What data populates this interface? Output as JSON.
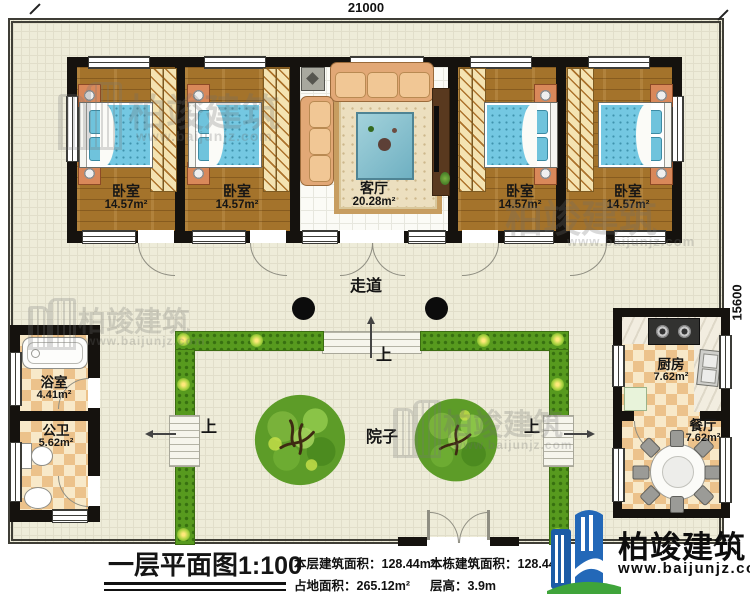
{
  "dims": {
    "top": "21000",
    "right": "15600"
  },
  "rooms": {
    "bedroom1": {
      "name": "卧室",
      "area": "14.57m²"
    },
    "bedroom2": {
      "name": "卧室",
      "area": "14.57m²"
    },
    "living": {
      "name": "客厅",
      "area": "20.28m²"
    },
    "bedroom3": {
      "name": "卧室",
      "area": "14.57m²"
    },
    "bedroom4": {
      "name": "卧室",
      "area": "14.57m²"
    },
    "bath": {
      "name": "浴室",
      "area": "4.41m²"
    },
    "wc": {
      "name": "公卫",
      "area": "5.62m²"
    },
    "kitchen": {
      "name": "厨房",
      "area": "7.62m²"
    },
    "dining": {
      "name": "餐厅",
      "area": "7.62m²"
    }
  },
  "labels": {
    "corridor": "走道",
    "courtyard": "院子",
    "up": "上"
  },
  "title": {
    "text": "一层平面图",
    "scale": "1:100"
  },
  "info": {
    "floor_area_label": "本层建筑面积：",
    "floor_area_value": "128.44m²",
    "site_area_label": "占地面积：",
    "site_area_value": "265.12m²",
    "total_area_label": "本栋建筑面积：",
    "total_area_value": "128.44m²",
    "height_label": "层高：",
    "height_value": "3.9m"
  },
  "brand": {
    "name": "柏竣建筑",
    "url": "www.baijunjz.com"
  },
  "icons": {
    "tree": "tree-icon",
    "column": "structural-column",
    "logo": "building-logo-icon",
    "flower": "flower-icon"
  },
  "colors": {
    "wall": "#15120e",
    "ground": "#eeecd9",
    "hedge": "#579a1e",
    "wood_floor": "#a4732b",
    "bed_blue": "#74c8e2",
    "checker_tan": "#ecc28b",
    "logo_blue": "#1c5ca6",
    "logo_green": "#3fa43a"
  }
}
